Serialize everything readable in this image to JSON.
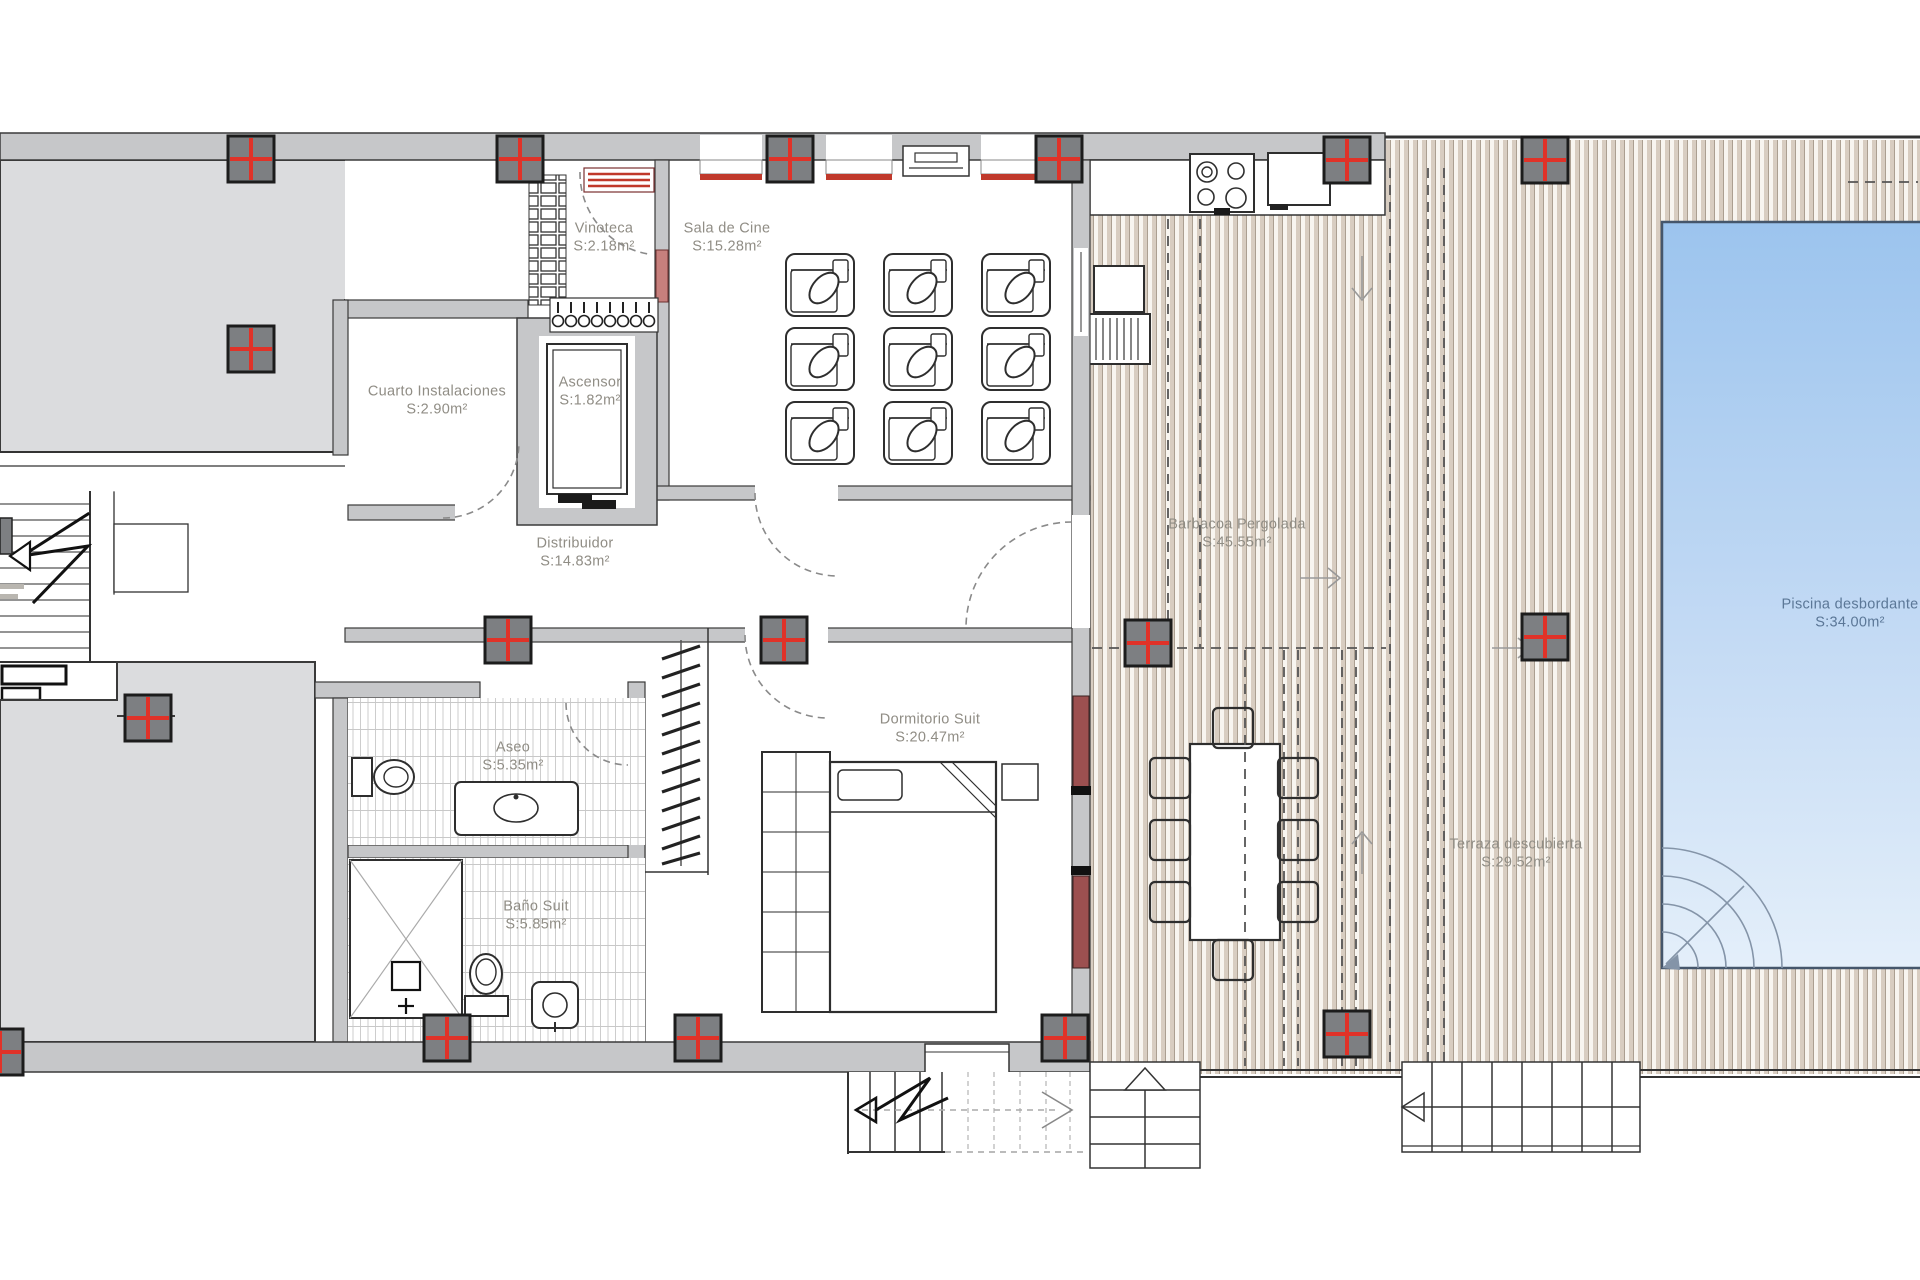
{
  "rooms": [
    {
      "id": "vinoteca",
      "name": "Vinoteca",
      "area": "S:2.18m²"
    },
    {
      "id": "sala-de-cine",
      "name": "Sala de Cine",
      "area": "S:15.28m²"
    },
    {
      "id": "cuarto-instalaciones",
      "name": "Cuarto Instalaciones",
      "area": "S:2.90m²"
    },
    {
      "id": "ascensor",
      "name": "Ascensor",
      "area": "S:1.82m²"
    },
    {
      "id": "distribuidor",
      "name": "Distribuidor",
      "area": "S:14.83m²"
    },
    {
      "id": "barbacoa-pergolada",
      "name": "Barbacoa Pergolada",
      "area": "S:45.55m²"
    },
    {
      "id": "piscina-desbordante",
      "name": "Piscina desbordante",
      "area": "S:34.00m²"
    },
    {
      "id": "aseo",
      "name": "Aseo",
      "area": "S:5.35m²"
    },
    {
      "id": "dormitorio-suit",
      "name": "Dormitorio Suit",
      "area": "S:20.47m²"
    },
    {
      "id": "bano-suit",
      "name": "Baño Suit",
      "area": "S:5.85m²"
    },
    {
      "id": "terraza-descubierta",
      "name": "Terraza descubierta",
      "area": "S:29.52m²"
    }
  ],
  "colors": {
    "pillar_marker_red": "#e03228",
    "wall_gray": "#c6c7c9",
    "terrace_gray": "#dbdcde",
    "deck_beige": "#d8cdc1",
    "pool_blue_top": "#9cc4ee",
    "pool_blue_bottom": "#e4effa",
    "label_gray": "#908d85",
    "pool_label_blue": "#5b7797",
    "accent_red": "#c0392b"
  }
}
